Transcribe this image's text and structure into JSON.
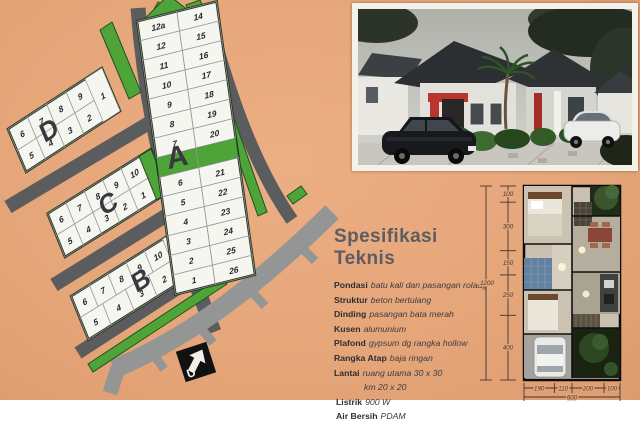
{
  "page": {
    "background": "#e5a67a"
  },
  "site_plan": {
    "block_a": {
      "name": "A",
      "left_top": [
        "12a",
        "12",
        "11",
        "10",
        "9",
        "8",
        "7"
      ],
      "right_top": [
        "14",
        "15",
        "16",
        "17",
        "18",
        "19",
        "20"
      ],
      "left_bottom": [
        "6",
        "5",
        "4",
        "3",
        "2",
        "1"
      ],
      "right_bottom": [
        "21",
        "22",
        "23",
        "24",
        "25",
        "26"
      ]
    },
    "block_b": {
      "name": "B",
      "top": [
        "6",
        "7",
        "8",
        "9",
        "10"
      ],
      "bottom": [
        "5",
        "4",
        "3",
        "2"
      ],
      "end_lot": "1"
    },
    "block_c": {
      "name": "C",
      "top": [
        "6",
        "7",
        "8",
        "9",
        "10"
      ],
      "bottom": [
        "5",
        "4",
        "3",
        "2",
        "1"
      ],
      "green_end": true
    },
    "block_d": {
      "name": "D",
      "top": [
        "6",
        "7",
        "8",
        "9"
      ],
      "bottom": [
        "5",
        "4",
        "3",
        "2"
      ],
      "end_lot": "1"
    },
    "north_label": "U",
    "colors": {
      "road": "#5b5c5e",
      "main_road": "#949695",
      "green": "#4fa437",
      "green_dark": "#1e5226",
      "lot_fill": "#f6f6f1",
      "lot_border": "#9a9a96",
      "block_border": "#263524",
      "number": "#26262b",
      "letter": "#38383e"
    }
  },
  "photo": {
    "frame_color": "#f4f1e9",
    "accent_red": "#bb3530"
  },
  "specs": {
    "title": "Spesifikasi Teknis",
    "items": [
      {
        "label": "Pondasi",
        "value": "batu kali dan pasangan rolaag"
      },
      {
        "label": "Struktur",
        "value": "beton bertulang"
      },
      {
        "label": "Dinding",
        "value": "pasangan bata merah"
      },
      {
        "label": "Kusen",
        "value": "alumunium"
      },
      {
        "label": "Plafond",
        "value": "gypsum dg rangka hollow"
      },
      {
        "label": "Rangka Atap",
        "value": "baja ringan"
      },
      {
        "label": "Lantai",
        "value": "ruang utama 30 x 30"
      },
      {
        "label": "",
        "value": "km 20 x 20"
      },
      {
        "label": "Listrik",
        "value": "900 W"
      },
      {
        "label": "Air Bersih",
        "value": "PDAM"
      }
    ]
  },
  "floor_plan": {
    "left_dims": [
      "100",
      "300",
      "150",
      "250",
      "400"
    ],
    "left_total": "1200",
    "bottom_dims": [
      "190",
      "110",
      "200",
      "100"
    ],
    "bottom_total": "600"
  }
}
